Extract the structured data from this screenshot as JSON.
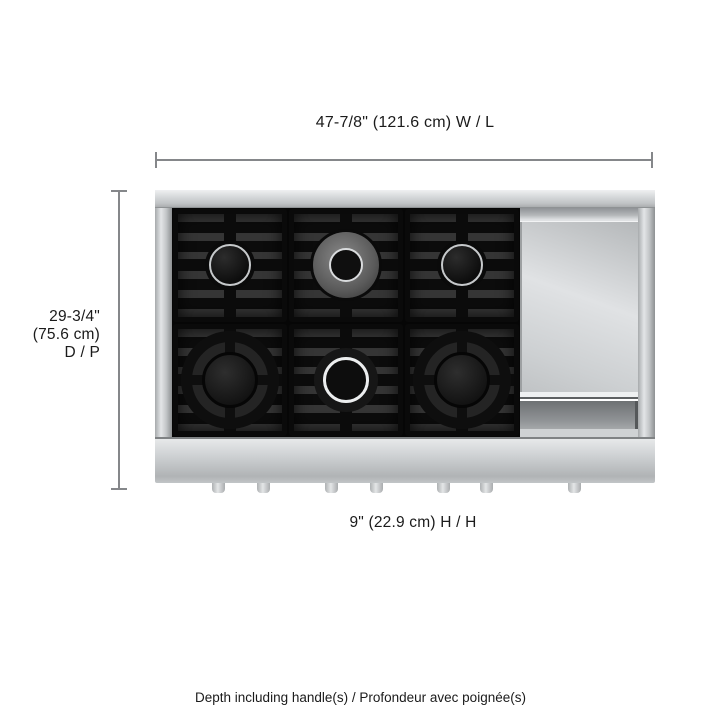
{
  "dimensions": {
    "width": "47-7/8\" (121.6 cm) W / L",
    "depth": {
      "line1": "29-3/4\"",
      "line2": "(75.6 cm)",
      "line3": "D / P"
    },
    "height": "9\" (22.9 cm) H / H"
  },
  "footnote": "Depth including handle(s) / Profondeur avec poignée(s)",
  "product": {
    "view": "rangetop top view diagram",
    "burners": [
      "top-left",
      "top-center",
      "top-right",
      "bottom-left",
      "bottom-center",
      "bottom-right"
    ],
    "griddle_present": true,
    "knob_stem_count": 7
  },
  "colors": {
    "background": "#ffffff",
    "text": "#1b1b1b",
    "dimension_line": "#85878a",
    "stainless": "#cdd0d2",
    "grate_black": "#0c0c0c",
    "chrome_ring": "#eceeef"
  }
}
